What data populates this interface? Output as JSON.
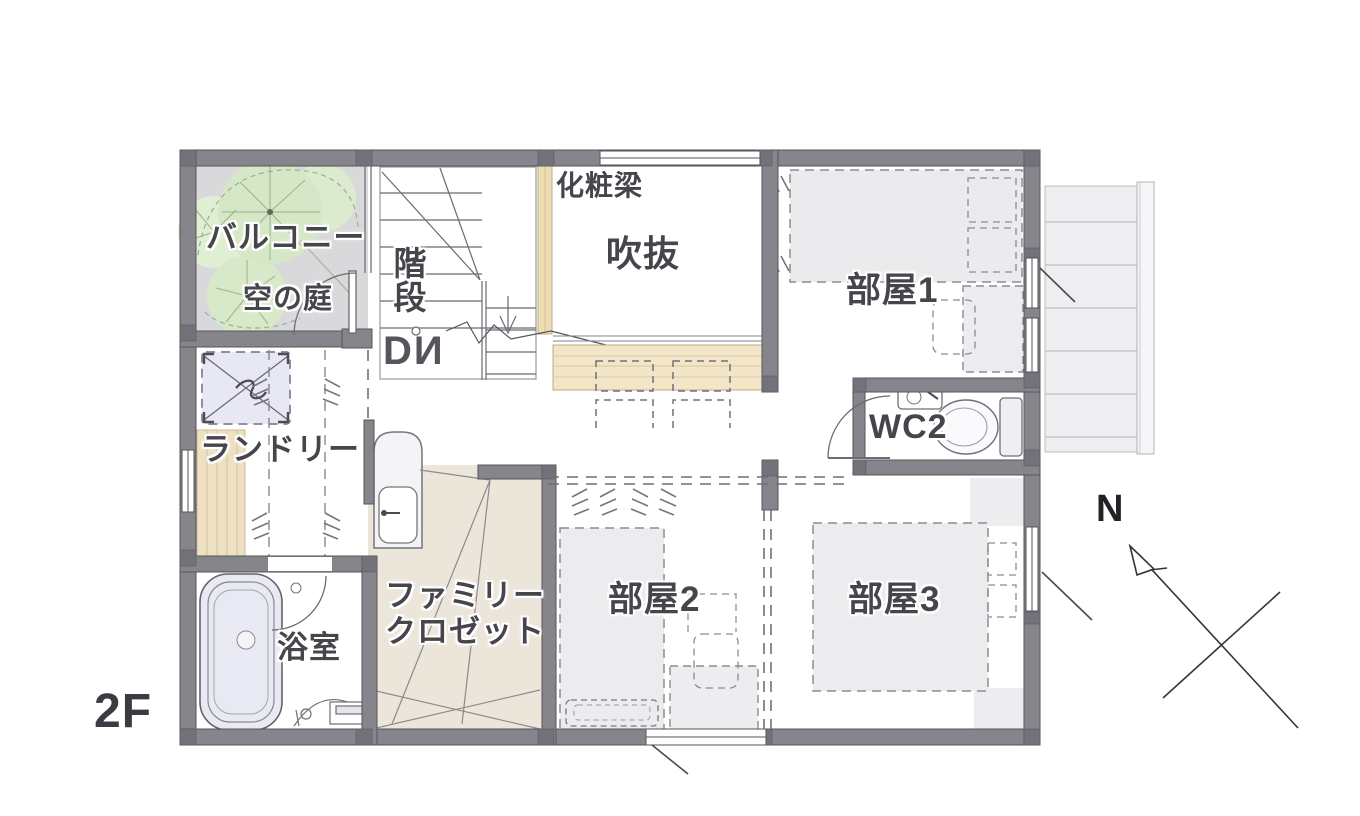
{
  "floor_label": "2F",
  "compass": {
    "north": "N"
  },
  "rooms": {
    "balcony": "バルコニー",
    "balcony_garden": "空の庭",
    "stairs": "階段",
    "stairs_down": "DИ",
    "void_beam": "化粧梁",
    "void": "吹抜",
    "room1": "部屋1",
    "wc": "WC2",
    "laundry": "ランドリー",
    "bathroom": "浴室",
    "family_closet_line1": "ファミリー",
    "family_closet_line2": "クロゼット",
    "room2": "部屋2",
    "room3": "部屋3"
  },
  "colors": {
    "wall": "#85858b",
    "wall_joint": "#72727a",
    "balcony_floor": "#d9d9db",
    "wood_counter": "#f2e5c8",
    "wood_floor": "#eee0c2",
    "closet_floor": "#ece5da",
    "bathtub": "#e9e9f4",
    "washer": "#e8e8f4",
    "tree_green": "#d5e7c6",
    "furniture_gray": "#ebebed",
    "label_text": "#45454b"
  }
}
